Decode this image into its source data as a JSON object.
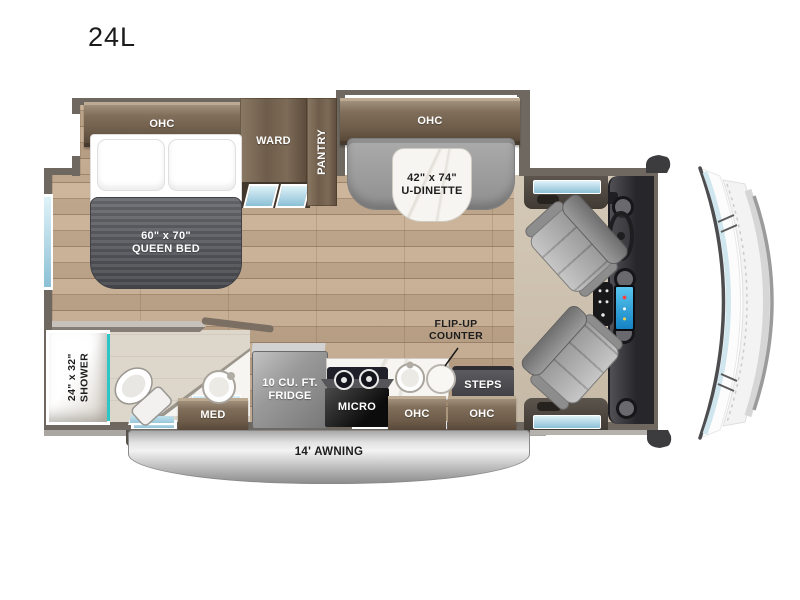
{
  "title": "24L",
  "rooms": {
    "bedroom": {
      "ohc": "OHC",
      "ward": "WARD",
      "pantry": "PANTRY",
      "bed_size": "60\" x 70\"",
      "bed_name": "QUEEN BED"
    },
    "dinette": {
      "ohc": "OHC",
      "size": "42\" x 74\"",
      "name": "U-DINETTE"
    },
    "bath": {
      "shower_size": "24\" x 32\"",
      "shower_name": "SHOWER",
      "med": "MED"
    },
    "kitchen": {
      "fridge_line1": "10 CU. FT.",
      "fridge_line2": "FRIDGE",
      "micro": "MICRO",
      "ohc": "OHC",
      "flipup_line1": "FLIP-UP",
      "flipup_line2": "COUNTER"
    },
    "entry": {
      "steps": "STEPS",
      "ohc": "OHC"
    },
    "exterior": {
      "awning": "14' AWNING"
    }
  },
  "colors": {
    "cabinet_wood": "#7b6a58",
    "floor_wood": "#c3aa8e",
    "wall_gray": "#6f6861",
    "accent_teal": "#2cc6c6",
    "window_glass": "#a8d4e4",
    "awning_silver": "#c9c9c9",
    "blanket_gray": "#55575c",
    "seat_gray": "#9a9a9a"
  }
}
